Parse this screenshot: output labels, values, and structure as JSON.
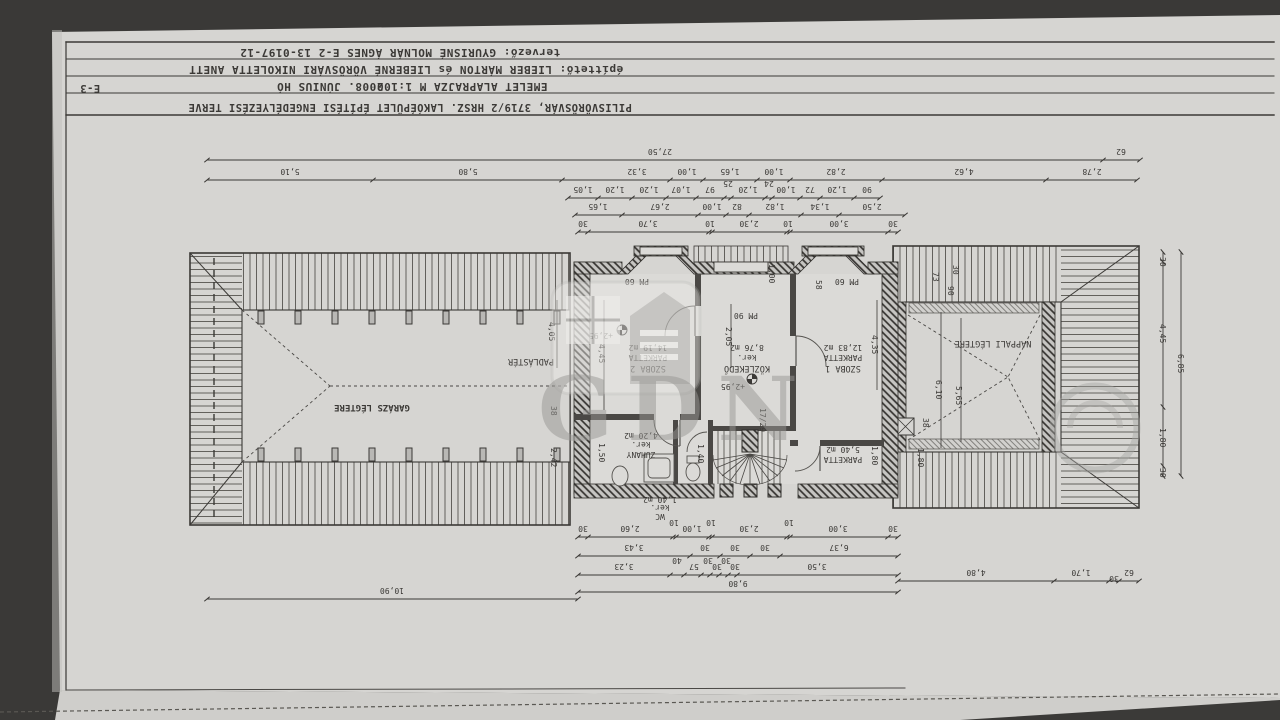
{
  "title_block": {
    "project": "PILISVÖRÖSVÁR, 3719/2 HRSZ. LAKÓÉPÜLET    ÉPÍTÉSI ENGEDÉLYEZÉSI TERVE",
    "drawing": "EMELET ALAPRAJZA    M 1:100",
    "date": "2008. JÚNIUS HÓ",
    "client": "építtető: LIEBER MÁRTON és LIEBERNÉ VÖRÖSVÁRI NIKOLETTA ANETT",
    "designer": "tervező: GYURISNÉ MOLNÁR ÁGNES    E-2 13-0197-12",
    "sheet_code": "E-3"
  },
  "watermark": {
    "text": "GDN"
  },
  "rooms": {
    "szoba2": {
      "name": "SZOBA 2",
      "finish": "PARKETTA",
      "area": "14,19 m2"
    },
    "kozlekedo": {
      "name": "KÖZLEKEDŐ",
      "finish": "ker.",
      "area": "8,76 m2"
    },
    "szoba1": {
      "name": "SZOBA 1",
      "finish": "PARKETTA",
      "area": "12,83 m2"
    },
    "zuhany": {
      "name": "ZUHANY",
      "finish": "ker.",
      "area": "4,20 m2"
    },
    "wc": {
      "name": "WC",
      "finish": "ker.",
      "area": "1,40 m2"
    },
    "gardrob": {
      "finish": "PARKETTA",
      "area": "5,40 m2"
    },
    "garazs": {
      "name": "GARÁZS LÉGTERE"
    },
    "padlaster": {
      "name": "PADLÁSTÉR"
    },
    "nappali": {
      "name": "NAPPALI LÉGTERE"
    }
  },
  "levels": {
    "szoba2": "+2,95",
    "kozlekedo": "+2,95"
  },
  "annotations": {
    "stair": "17/29",
    "pm60": "PM 60",
    "pm90": "PM 90"
  },
  "dims": {
    "t1": {
      "total": "27,50",
      "end": "62"
    },
    "t2": [
      "5,10",
      "5,80",
      "3,32",
      "1,00",
      "1,65",
      "1,00",
      "2,82",
      "4,62",
      "2,78"
    ],
    "t3": [
      "1,05",
      "1,20",
      "1,20",
      "1,07",
      "97",
      "25",
      "1,20",
      "24",
      "1,00",
      "72",
      "1,20",
      "90"
    ],
    "t4": [
      "1,65",
      "2,67",
      "1,00",
      "82",
      "1,82",
      "1,34",
      "2,50"
    ],
    "t5": [
      "30",
      "3,70",
      "10",
      "2,30",
      "10",
      "3,00",
      "30"
    ],
    "b1": [
      "30",
      "2,60",
      "10",
      "1,00",
      "10",
      "2,30",
      "10",
      "3,00",
      "30"
    ],
    "b2": [
      "3,43",
      "30",
      "30",
      "30",
      "6,37"
    ],
    "b3": [
      "3,23",
      "40",
      "57",
      "30",
      "30",
      "30",
      "30",
      "3,50"
    ],
    "b4": "9,80",
    "b5": "10,90",
    "b6": [
      "4,80",
      "1,70",
      "30",
      "62"
    ],
    "right": {
      "segs": [
        "30",
        "4,45",
        "1,80",
        "30"
      ],
      "total": "6,85"
    },
    "inner": {
      "padlas_w": "4,05",
      "g38": "38",
      "g242": "2,42",
      "sz2_h": "4,45",
      "zu_h": "1,50",
      "koz_h": "2,05",
      "d100": "1,00",
      "d58": "58",
      "sz1_h": "4,35",
      "wc_h": "1,40",
      "gar_h": "1,80",
      "n73": "73",
      "n30": "30",
      "n90": "90",
      "n38": "38",
      "n180": "1,80",
      "nap_w1": "6,10",
      "nap_w2": "5,65"
    }
  }
}
